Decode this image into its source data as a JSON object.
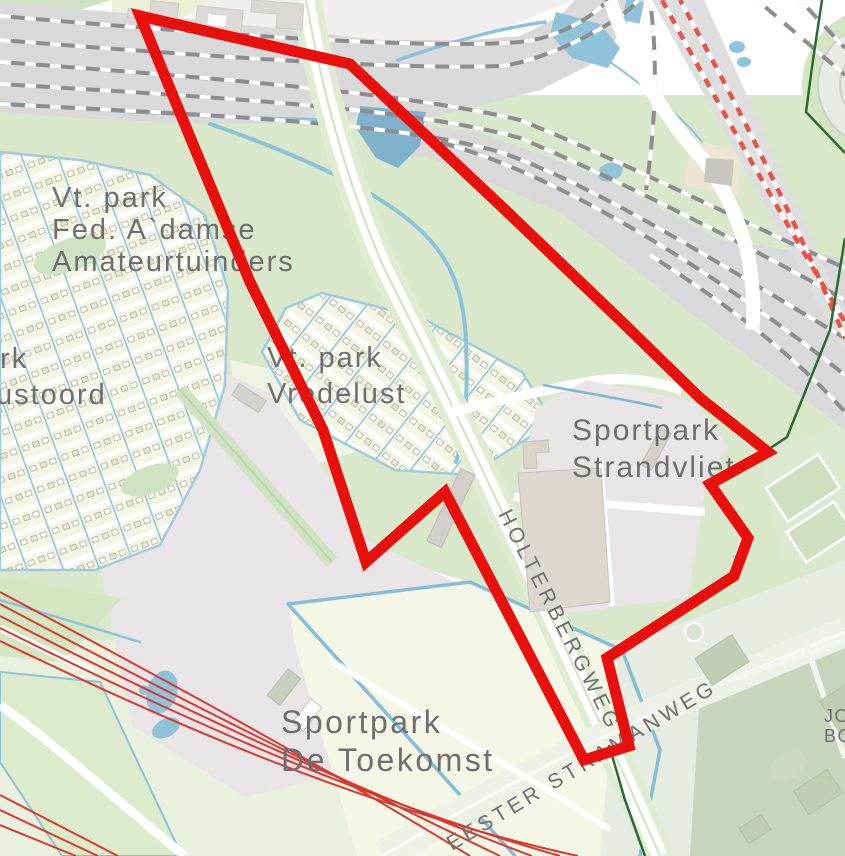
{
  "map": {
    "labels": {
      "amateurtuinders": {
        "line1": "Vt. park",
        "line2": "Fed. A`damse",
        "line3": "Amateurtuinders"
      },
      "rustoord": {
        "line1": "ark",
        "line2": "ustoord"
      },
      "vredelust": {
        "line1": "Vt. park",
        "line2": "Vredelust"
      },
      "strandvliet": {
        "line1": "Sportpark",
        "line2": "Strandvliet"
      },
      "de_toekomst": {
        "line1": "Sportpark",
        "line2": "De Toekomst"
      },
      "holterbergweg": "HOLTERBERGWEG",
      "stramanweg": "EESTER STRAMANWEG",
      "edge_fragment": {
        "line1": "JO",
        "line2": "BO"
      }
    },
    "colors": {
      "selection_outline": "#e8100c",
      "thin_red_lines": "#d6392f",
      "water": "#8fc3da",
      "water_dark": "#7fb0cc",
      "rail_band": "#d9d9d9",
      "rail_track": "#8d8d8d",
      "metro_red": "#e4544a",
      "park_green": "#d9e8ca",
      "pale_green": "#e9f0dd",
      "allotment_cream": "#f3f6e2",
      "field_cream": "#f4f7e6",
      "urban_pale": "#f1eeee",
      "lot_gray": "#e9e5e7",
      "building_khaki": "#dcd8d0",
      "business_sage": "#c9d4bd",
      "boundary_green": "#2a6b34",
      "label_text": "#6e6e6e"
    }
  }
}
